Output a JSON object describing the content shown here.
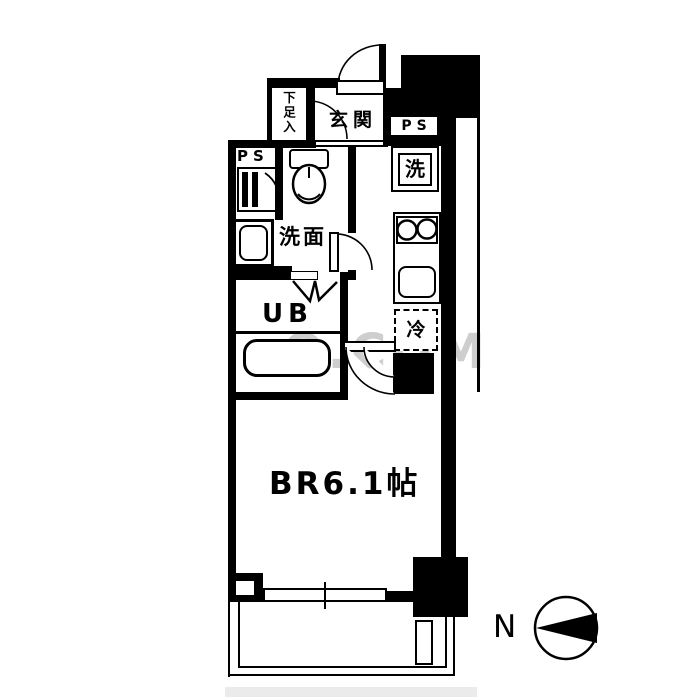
{
  "plan": {
    "type": "apartment-floor-plan",
    "labels": {
      "entrance": "玄関",
      "shoe_storage": "下足入",
      "ps_left": "PS",
      "ps_right": "PS",
      "washing_machine": "洗",
      "washroom": "洗面",
      "unit_bath": "UB",
      "refrigerator": "冷",
      "bedroom": "BR6.1帖",
      "compass_north": "N"
    },
    "fixtures": [
      "entrance-door",
      "hall-door",
      "washroom-door",
      "bedroom-door",
      "bifold-bath-door",
      "toilet",
      "vanity-sink",
      "meter-box",
      "bathtub",
      "stove-burners",
      "kitchen-sink",
      "sliding-window",
      "balcony",
      "balcony-partition",
      "compass"
    ],
    "watermark": {
      "text": "O.COM"
    },
    "colors": {
      "walls": "#000000",
      "background": "#ffffff",
      "watermark": "#9e9e9e"
    }
  }
}
